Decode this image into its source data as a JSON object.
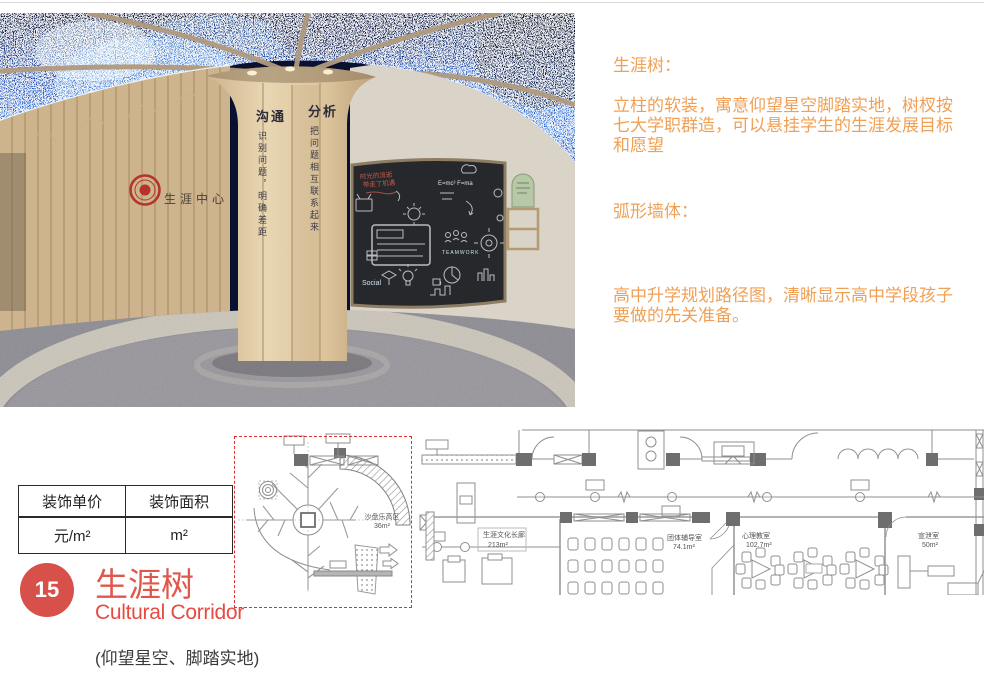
{
  "photo": {
    "wall_sign": "生涯中心",
    "column_signs": [
      {
        "heading": "沟通",
        "caption": "识别问题，明确差距"
      },
      {
        "heading": "分析",
        "caption": "把问题相互联系起来"
      }
    ],
    "chalk": {
      "red_line1": "时光的流逝",
      "red_line2": "带走了机遇",
      "word1": "Social",
      "word2": "TEAMWORK",
      "word3": "E=mc²  F=ma"
    }
  },
  "annotations": {
    "tree_heading": "生涯树：",
    "tree_body": "立柱的软装，寓意仰望星空脚踏实地，树杈按\n七大学职群造，可以悬挂学生的生涯发展目标\n和愿望",
    "wall_heading": "弧形墙体：",
    "wall_body": "高中升学规划路径图，清晰显示高中学段孩子\n要做的先关准备。"
  },
  "spec_table": {
    "headers": [
      "装饰单价",
      "装饰面积"
    ],
    "values": [
      "元/m²",
      "m²"
    ]
  },
  "floor_plan": {
    "rooms": [
      {
        "name": "沙盘乐高区",
        "area": "36m²"
      },
      {
        "name": "生涯文化长廊",
        "area": "213m²"
      },
      {
        "name": "团体辅导室",
        "area": "74.1m²"
      },
      {
        "name": "心理教室",
        "area": "102.7m²"
      },
      {
        "name": "宣泄室",
        "area": "50m²"
      }
    ]
  },
  "footer": {
    "index": "15",
    "title": "生涯树",
    "subtitle": "Cultural Corridor",
    "tagline": "(仰望星空、脚踏实地)"
  },
  "colors": {
    "annotation_orange": "#F0A055",
    "title_red": "#E0584C",
    "subtitle_red": "#E84A43",
    "badge_red": "#D8504A",
    "highlight_dashed_red": "#E23030",
    "seal_red": "#B5342A",
    "chalkboard": "#26282B",
    "sky_blue": "#1E56C8",
    "wood_tan": "#D6BD96"
  }
}
